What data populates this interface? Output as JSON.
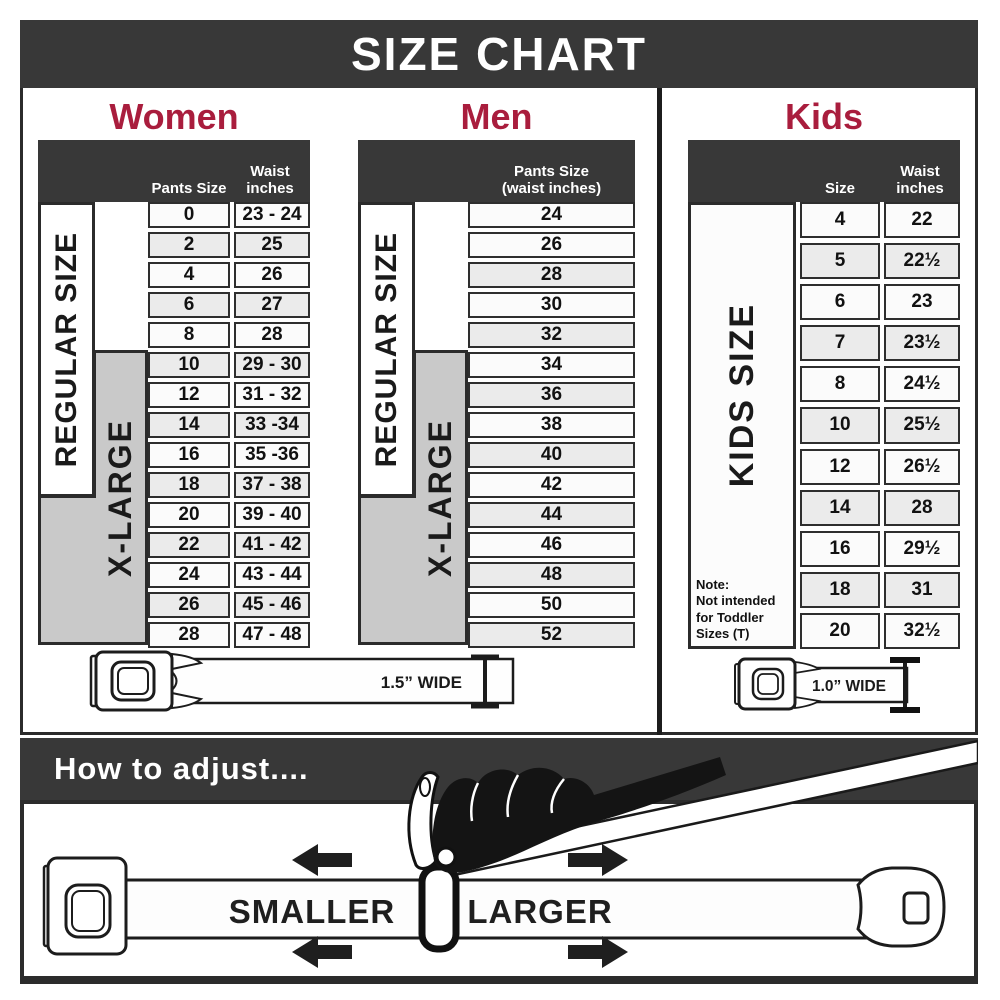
{
  "title": "SIZE CHART",
  "colors": {
    "accent": "#A91D3D",
    "bar": "#383838",
    "xlarge_bg": "#C9C9C9"
  },
  "women": {
    "heading": "Women",
    "pants_header": "Pants Size",
    "waist_header": "Waist inches",
    "regular_label": "REGULAR SIZE",
    "xlarge_label": "X-LARGE",
    "rows": [
      {
        "size": "0",
        "waist": "23 - 24"
      },
      {
        "size": "2",
        "waist": "25"
      },
      {
        "size": "4",
        "waist": "26"
      },
      {
        "size": "6",
        "waist": "27"
      },
      {
        "size": "8",
        "waist": "28"
      },
      {
        "size": "10",
        "waist": "29 - 30"
      },
      {
        "size": "12",
        "waist": "31 - 32"
      },
      {
        "size": "14",
        "waist": "33 -34"
      },
      {
        "size": "16",
        "waist": "35 -36"
      },
      {
        "size": "18",
        "waist": "37 - 38"
      },
      {
        "size": "20",
        "waist": "39 - 40"
      },
      {
        "size": "22",
        "waist": "41 - 42"
      },
      {
        "size": "24",
        "waist": "43 - 44"
      },
      {
        "size": "26",
        "waist": "45 - 46"
      },
      {
        "size": "28",
        "waist": "47 - 48"
      }
    ]
  },
  "men": {
    "heading": "Men",
    "header_line1": "Pants Size",
    "header_line2": "(waist inches)",
    "regular_label": "REGULAR SIZE",
    "xlarge_label": "X-LARGE",
    "rows": [
      "24",
      "26",
      "28",
      "30",
      "32",
      "34",
      "36",
      "38",
      "40",
      "42",
      "44",
      "46",
      "48",
      "50",
      "52"
    ]
  },
  "kids": {
    "heading": "Kids",
    "size_header": "Size",
    "waist_header": "Waist inches",
    "side_label": "KIDS SIZE",
    "note_label": "Note:",
    "note_text": "Not intended for Toddler Sizes (T)",
    "rows": [
      {
        "size": "4",
        "waist": "22"
      },
      {
        "size": "5",
        "waist": "22½"
      },
      {
        "size": "6",
        "waist": "23"
      },
      {
        "size": "7",
        "waist": "23½"
      },
      {
        "size": "8",
        "waist": "24½"
      },
      {
        "size": "10",
        "waist": "25½"
      },
      {
        "size": "12",
        "waist": "26½"
      },
      {
        "size": "14",
        "waist": "28"
      },
      {
        "size": "16",
        "waist": "29½"
      },
      {
        "size": "18",
        "waist": "31"
      },
      {
        "size": "20",
        "waist": "32½"
      }
    ]
  },
  "belts": {
    "adult_label": "1.5” WIDE",
    "kids_label": "1.0” WIDE"
  },
  "adjust": {
    "heading": "How to adjust....",
    "smaller": "SMALLER",
    "larger": "LARGER"
  }
}
